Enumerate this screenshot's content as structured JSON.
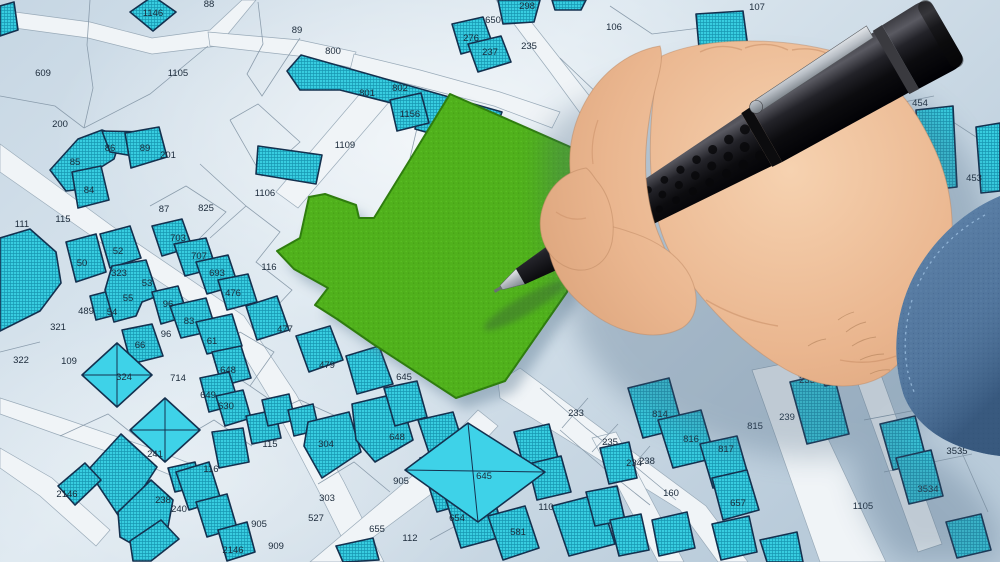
{
  "map": {
    "description_labels_note": "cadastral parcel numbers visible on the map",
    "parcel_labels": [
      {
        "t": "88",
        "x": 209,
        "y": 4
      },
      {
        "t": "1146",
        "x": 153,
        "y": 13
      },
      {
        "t": "89",
        "x": 297,
        "y": 30
      },
      {
        "t": "609",
        "x": 43,
        "y": 73
      },
      {
        "t": "1105",
        "x": 178,
        "y": 73
      },
      {
        "t": "200",
        "x": 60,
        "y": 124
      },
      {
        "t": "800",
        "x": 333,
        "y": 51
      },
      {
        "t": "801",
        "x": 367,
        "y": 93
      },
      {
        "t": "802",
        "x": 400,
        "y": 88
      },
      {
        "t": "1156",
        "x": 410,
        "y": 114
      },
      {
        "t": "1109",
        "x": 345,
        "y": 145
      },
      {
        "t": "650",
        "x": 493,
        "y": 20
      },
      {
        "t": "298",
        "x": 527,
        "y": 6
      },
      {
        "t": "276",
        "x": 471,
        "y": 38
      },
      {
        "t": "237",
        "x": 490,
        "y": 52
      },
      {
        "t": "235",
        "x": 529,
        "y": 46
      },
      {
        "t": "106",
        "x": 614,
        "y": 27
      },
      {
        "t": "107",
        "x": 757,
        "y": 7
      },
      {
        "t": "823",
        "x": 918,
        "y": 50
      },
      {
        "t": "455",
        "x": 856,
        "y": 79
      },
      {
        "t": "454",
        "x": 920,
        "y": 103
      },
      {
        "t": "453",
        "x": 974,
        "y": 178
      },
      {
        "t": "85",
        "x": 75,
        "y": 162
      },
      {
        "t": "86",
        "x": 110,
        "y": 148
      },
      {
        "t": "89",
        "x": 145,
        "y": 148
      },
      {
        "t": "201",
        "x": 168,
        "y": 155
      },
      {
        "t": "84",
        "x": 89,
        "y": 190
      },
      {
        "t": "87",
        "x": 164,
        "y": 209
      },
      {
        "t": "825",
        "x": 206,
        "y": 208
      },
      {
        "t": "1106",
        "x": 265,
        "y": 193
      },
      {
        "t": "111",
        "x": 22,
        "y": 224
      },
      {
        "t": "115",
        "x": 63,
        "y": 219
      },
      {
        "t": "703",
        "x": 178,
        "y": 238
      },
      {
        "t": "707",
        "x": 199,
        "y": 256
      },
      {
        "t": "693",
        "x": 217,
        "y": 273
      },
      {
        "t": "50",
        "x": 82,
        "y": 263
      },
      {
        "t": "52",
        "x": 118,
        "y": 251
      },
      {
        "t": "323",
        "x": 119,
        "y": 273
      },
      {
        "t": "53",
        "x": 147,
        "y": 283
      },
      {
        "t": "55",
        "x": 128,
        "y": 298
      },
      {
        "t": "476",
        "x": 233,
        "y": 293
      },
      {
        "t": "96",
        "x": 168,
        "y": 304
      },
      {
        "t": "489",
        "x": 86,
        "y": 311
      },
      {
        "t": "54",
        "x": 112,
        "y": 312
      },
      {
        "t": "321",
        "x": 58,
        "y": 327
      },
      {
        "t": "83",
        "x": 189,
        "y": 321
      },
      {
        "t": "96",
        "x": 166,
        "y": 334
      },
      {
        "t": "66",
        "x": 140,
        "y": 345
      },
      {
        "t": "61",
        "x": 212,
        "y": 341
      },
      {
        "t": "322",
        "x": 21,
        "y": 360
      },
      {
        "t": "109",
        "x": 69,
        "y": 361
      },
      {
        "t": "324",
        "x": 124,
        "y": 377
      },
      {
        "t": "714",
        "x": 178,
        "y": 378
      },
      {
        "t": "648",
        "x": 228,
        "y": 370
      },
      {
        "t": "649",
        "x": 208,
        "y": 395
      },
      {
        "t": "630",
        "x": 226,
        "y": 406
      },
      {
        "t": "116",
        "x": 269,
        "y": 267
      },
      {
        "t": "477",
        "x": 285,
        "y": 329
      },
      {
        "t": "479",
        "x": 327,
        "y": 365
      },
      {
        "t": "645",
        "x": 404,
        "y": 377
      },
      {
        "t": "2146",
        "x": 67,
        "y": 494
      },
      {
        "t": "241",
        "x": 155,
        "y": 454
      },
      {
        "t": "238",
        "x": 163,
        "y": 500
      },
      {
        "t": "240",
        "x": 179,
        "y": 509
      },
      {
        "t": "116",
        "x": 211,
        "y": 469
      },
      {
        "t": "115",
        "x": 270,
        "y": 444
      },
      {
        "t": "905",
        "x": 259,
        "y": 524
      },
      {
        "t": "2146",
        "x": 233,
        "y": 550
      },
      {
        "t": "909",
        "x": 276,
        "y": 546
      },
      {
        "t": "304",
        "x": 326,
        "y": 444
      },
      {
        "t": "303",
        "x": 327,
        "y": 498
      },
      {
        "t": "527",
        "x": 316,
        "y": 518
      },
      {
        "t": "648",
        "x": 397,
        "y": 437
      },
      {
        "t": "645",
        "x": 484,
        "y": 476
      },
      {
        "t": "654",
        "x": 457,
        "y": 518
      },
      {
        "t": "655",
        "x": 377,
        "y": 529
      },
      {
        "t": "112",
        "x": 410,
        "y": 538
      },
      {
        "t": "905",
        "x": 401,
        "y": 481
      },
      {
        "t": "110",
        "x": 546,
        "y": 507
      },
      {
        "t": "581",
        "x": 518,
        "y": 532
      },
      {
        "t": "233",
        "x": 576,
        "y": 413
      },
      {
        "t": "235",
        "x": 610,
        "y": 442
      },
      {
        "t": "238",
        "x": 647,
        "y": 461
      },
      {
        "t": "234",
        "x": 634,
        "y": 463
      },
      {
        "t": "814",
        "x": 660,
        "y": 414
      },
      {
        "t": "816",
        "x": 691,
        "y": 439
      },
      {
        "t": "817",
        "x": 726,
        "y": 449
      },
      {
        "t": "815",
        "x": 755,
        "y": 426
      },
      {
        "t": "239",
        "x": 787,
        "y": 417
      },
      {
        "t": "235",
        "x": 807,
        "y": 380
      },
      {
        "t": "657",
        "x": 738,
        "y": 503
      },
      {
        "t": "160",
        "x": 671,
        "y": 493
      },
      {
        "t": "1105",
        "x": 863,
        "y": 506
      },
      {
        "t": "3534",
        "x": 928,
        "y": 489
      },
      {
        "t": "3535",
        "x": 957,
        "y": 451
      }
    ],
    "colors": {
      "map_background": "#cfdde8",
      "road": "#f0f4f7",
      "parcel_fill": "#38cde0",
      "parcel_border": "#14314f",
      "highlight_green": "#50b11c",
      "highlight_border": "#2f7d0e",
      "label": "#1b2a3a",
      "pen_black": "#141417",
      "skin": "#e9b48e",
      "sleeve_blue": "#53779e"
    }
  },
  "overlay": {
    "hand": "right-hand-holding-pen",
    "pen": "black-mechanical-pencil-with-metal-clip",
    "sleeve": "blue-shirt-cuff"
  }
}
